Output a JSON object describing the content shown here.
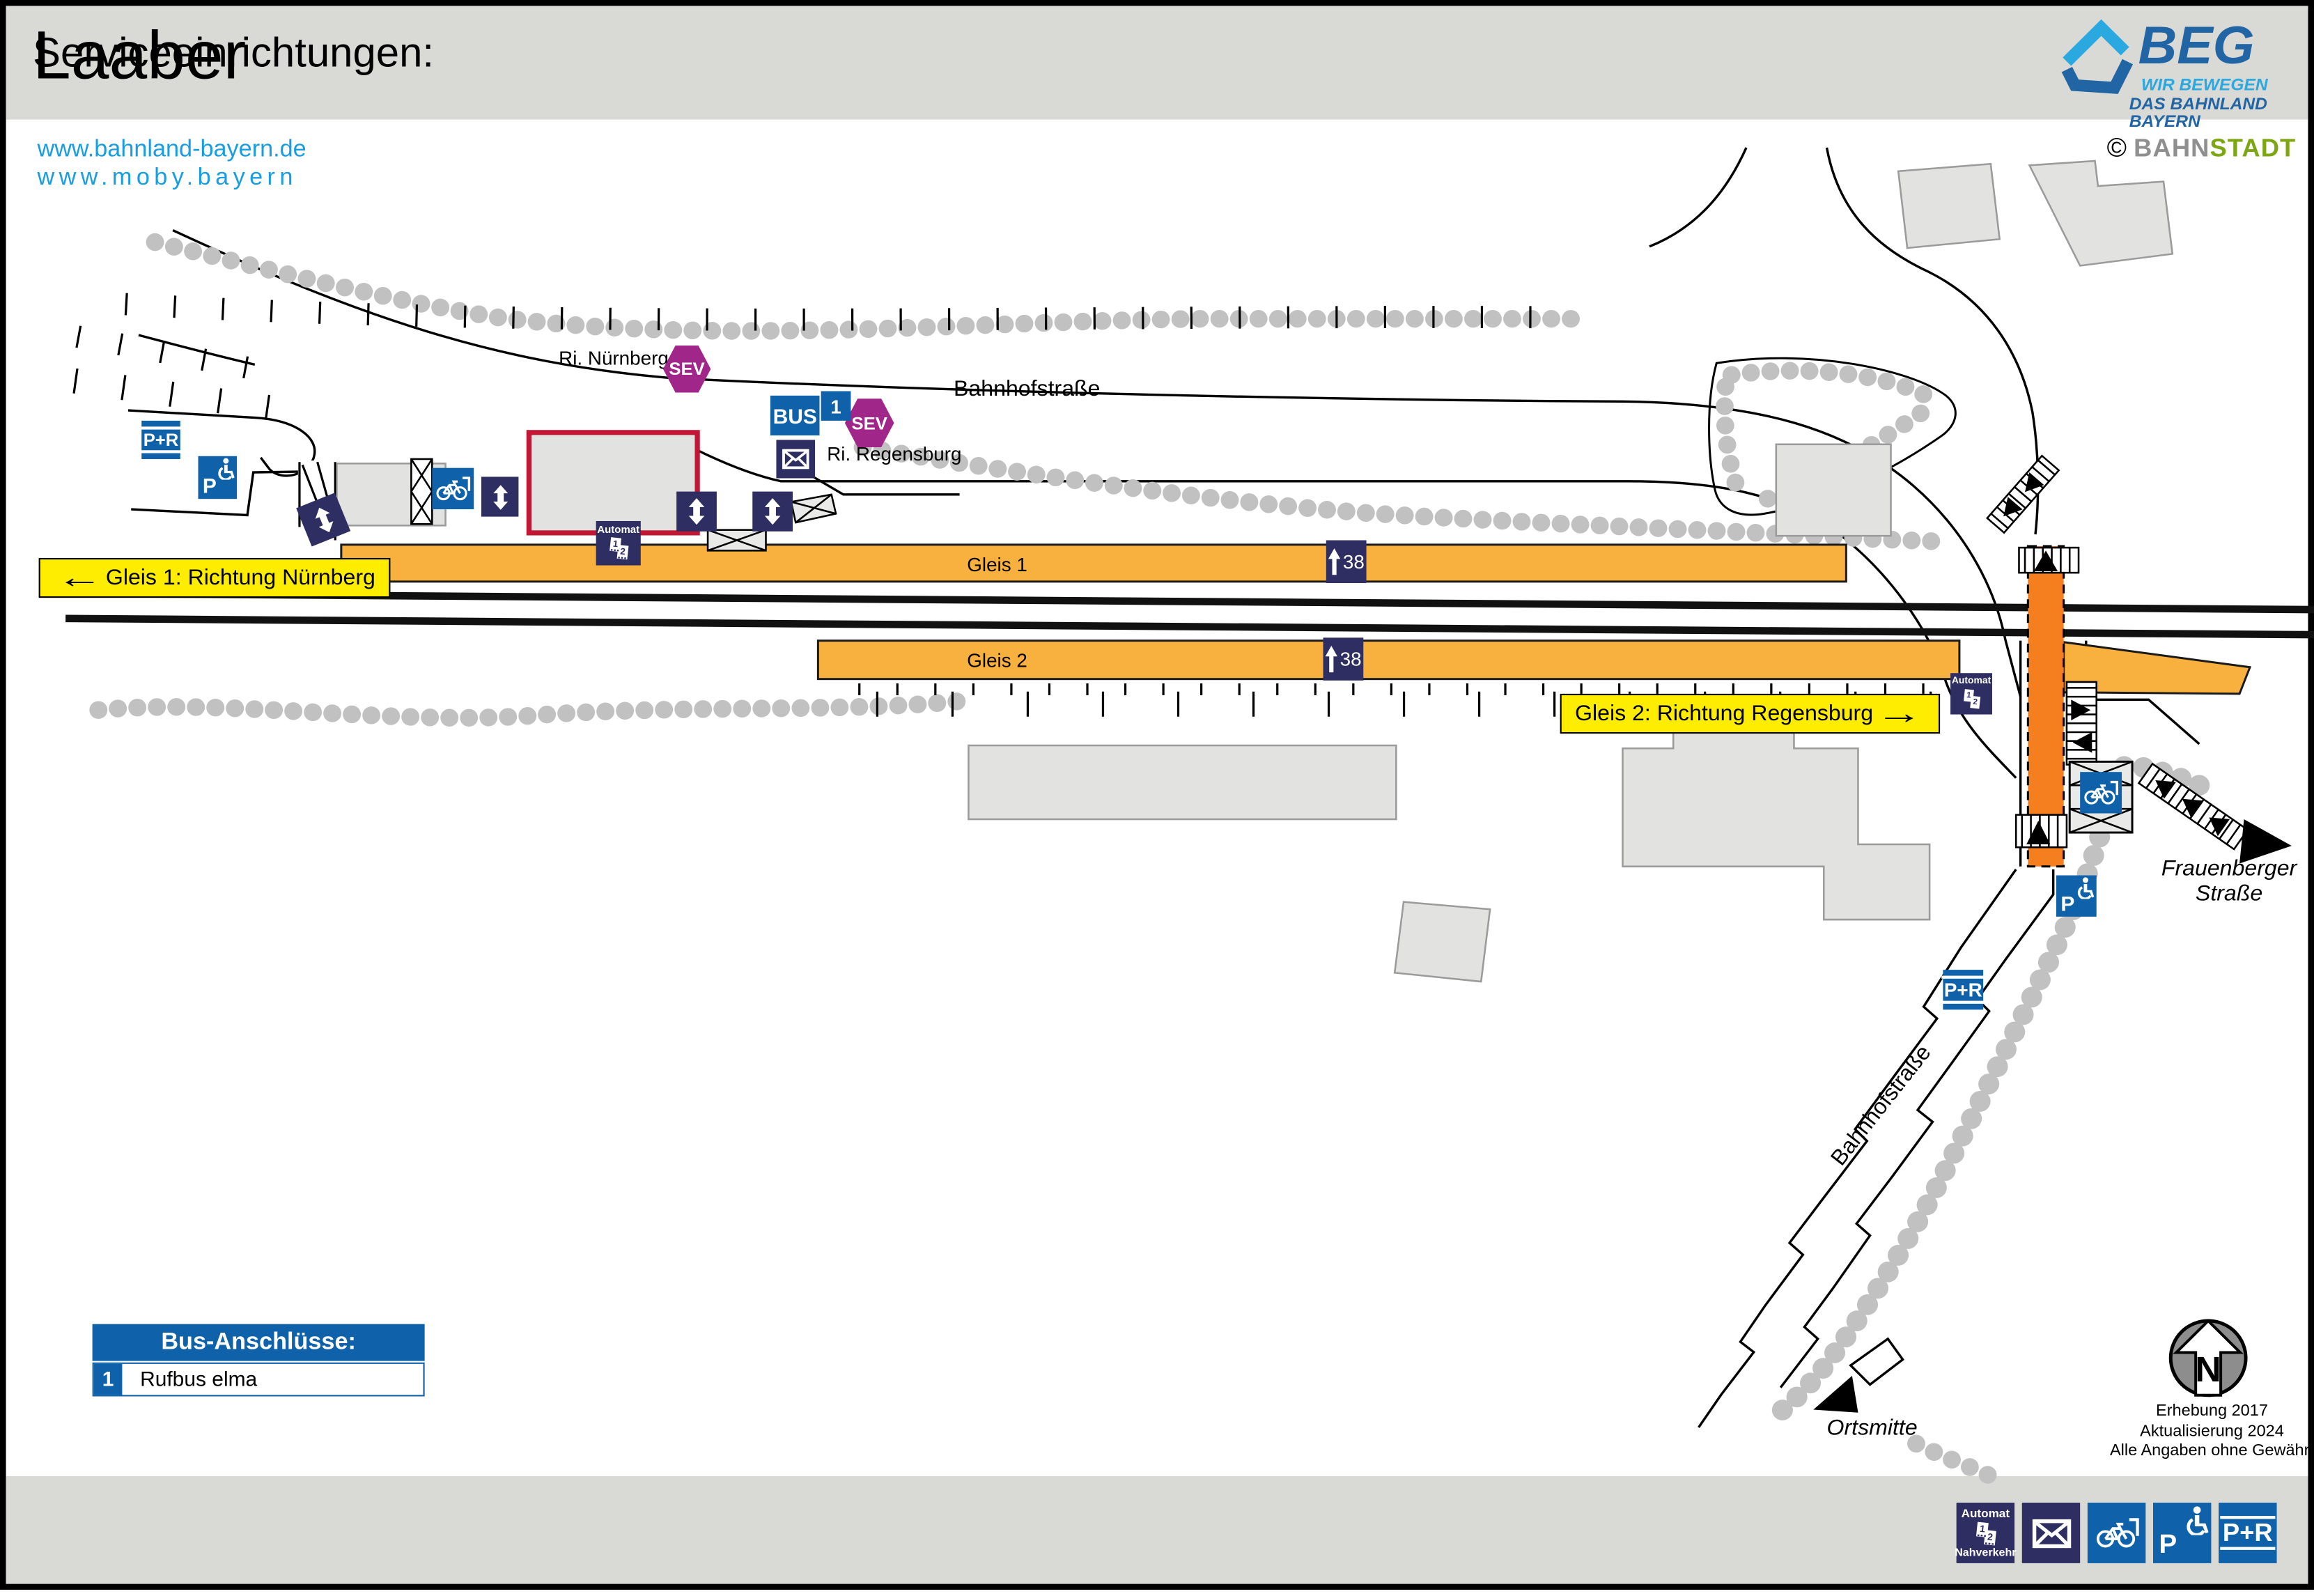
{
  "header": {
    "title": "Laaber",
    "links": [
      "www.bahnland-bayern.de",
      "www.moby.bayern"
    ],
    "beg": {
      "name": "BEG",
      "line1": "WIR BEWEGEN",
      "line2": "DAS BAHNLAND BAYERN"
    },
    "credit": {
      "copyright": "©",
      "part1": "BAHN",
      "part2": "STADT"
    }
  },
  "map": {
    "street_labels": {
      "ri_nuernberg": "Ri. Nürnberg",
      "bahnhofstrasse_top": "Bahnhofstraße",
      "ri_regensburg": "Ri. Regensburg",
      "bahnhofstrasse_south": "Bahnhofstraße",
      "frauenberger_line1": "Frauenberger",
      "frauenberger_line2": "Straße",
      "ortsmitte": "Ortsmitte"
    },
    "platforms": {
      "gleis1": "Gleis 1",
      "gleis2": "Gleis 2",
      "height": "38"
    },
    "directions": {
      "gleis1": "Gleis 1: Richtung Nürnberg",
      "gleis2": "Gleis 2: Richtung Regensburg",
      "arrow_left": "←",
      "arrow_right": "→"
    },
    "icons": {
      "sev": "SEV",
      "bus": "BUS",
      "line1": "1",
      "pr": "P+R",
      "p": "P",
      "automat": "Automat",
      "nahverkehr": "Nahverkehr",
      "ticket1": "1",
      "ticket2": "2"
    },
    "north": "N",
    "notes": [
      "Erhebung 2017",
      "Aktualisierung 2024",
      "Alle Angaben ohne Gewähr!"
    ]
  },
  "bus_box": {
    "title": "Bus-Anschlüsse:",
    "routes": [
      {
        "number": "1",
        "name": "Rufbus elma"
      }
    ]
  },
  "footer": {
    "title": "Serviceeinrichtungen:"
  },
  "colors": {
    "platform_orange": "#F8B13F",
    "crossing_orange": "#F57E1E",
    "icon_blue": "#0F62A9",
    "icon_navy": "#2F2E63",
    "sev_purple": "#A02689",
    "label_yellow": "#FFED00",
    "band_gray": "#D9D9D6",
    "tree_gray": "#C1C1C1",
    "building_red": "#C11735",
    "link_blue": "#189DE2"
  }
}
